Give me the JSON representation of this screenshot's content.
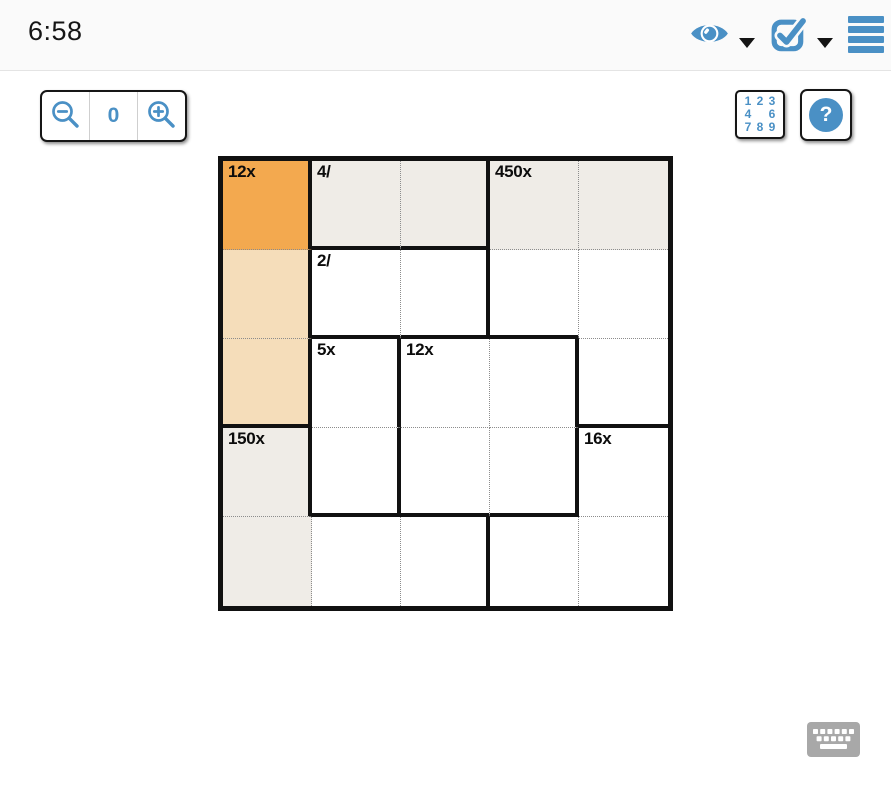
{
  "colors": {
    "accent_blue": "#4A90C5",
    "selected_cell": "#F3A94F",
    "cage_highlight": "#F5DDBA",
    "rowcol_highlight": "#EFECE7",
    "cell_white": "#FFFFFF",
    "line_thick": "#111111",
    "line_dotted": "#8C8C8C",
    "keyboard_gray": "#A8A8A8",
    "topbar_bg": "#FAFAFA"
  },
  "header": {
    "timer": "6:58",
    "icons": [
      "eye-icon",
      "caret-down-icon",
      "checkbox-check-icon",
      "caret-down-icon",
      "menu-icon"
    ]
  },
  "zoom_panel": {
    "value": "0",
    "icons": [
      "zoom-out-icon",
      "zoom-in-icon"
    ]
  },
  "numpad_button": {
    "icon": "number-grid-icon",
    "digits": [
      "1",
      "2",
      "3",
      "4",
      "",
      "6",
      "7",
      "8",
      "9"
    ]
  },
  "help_button": {
    "icon": "question-circle-icon",
    "label": "?"
  },
  "keyboard_button": {
    "icon": "keyboard-icon"
  },
  "board": {
    "size": 5,
    "cages": {
      "A": "12x",
      "B": "4/",
      "C": "450x",
      "D": "2/",
      "E": "5x",
      "F": "12x",
      "G": "150x",
      "H": "16x"
    },
    "cage_grid": [
      [
        "A",
        "B",
        "B",
        "C",
        "C"
      ],
      [
        "A",
        "D",
        "D",
        "C",
        "C"
      ],
      [
        "A",
        "E",
        "F",
        "F",
        "C"
      ],
      [
        "G",
        "E",
        "F",
        "F",
        "H"
      ],
      [
        "G",
        "G",
        "G",
        "H",
        "H"
      ]
    ],
    "cell_bg": [
      [
        "selected_cell",
        "rowcol_highlight",
        "rowcol_highlight",
        "rowcol_highlight",
        "rowcol_highlight"
      ],
      [
        "cage_highlight",
        "cell_white",
        "cell_white",
        "cell_white",
        "cell_white"
      ],
      [
        "cage_highlight",
        "cell_white",
        "cell_white",
        "cell_white",
        "cell_white"
      ],
      [
        "rowcol_highlight",
        "cell_white",
        "cell_white",
        "cell_white",
        "cell_white"
      ],
      [
        "rowcol_highlight",
        "cell_white",
        "cell_white",
        "cell_white",
        "cell_white"
      ]
    ],
    "cell_values": []
  }
}
